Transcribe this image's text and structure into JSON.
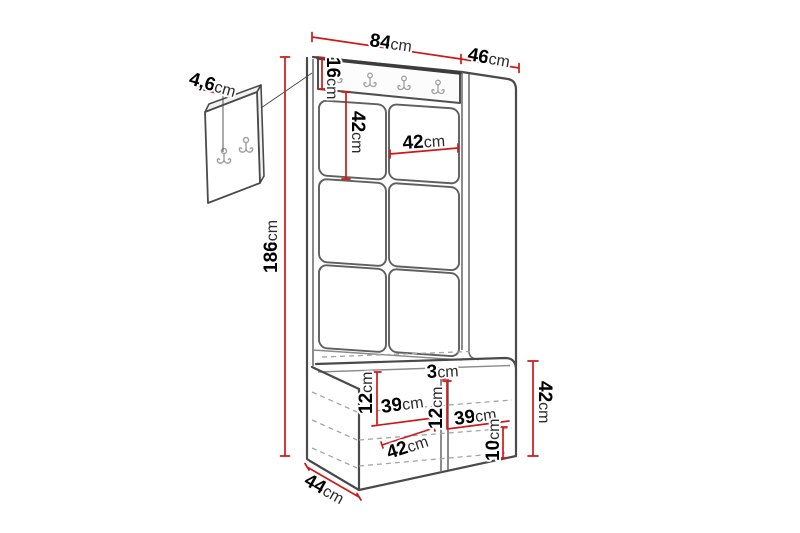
{
  "unit": "cm",
  "diagram": {
    "type": "furniture dimension diagram",
    "dimensions": {
      "wall_panel_thickness": {
        "value": "4,6"
      },
      "total_width": {
        "value": "84"
      },
      "total_depth": {
        "value": "46"
      },
      "hook_rail_height": {
        "value": "16"
      },
      "panel_tile_height": {
        "value": "42"
      },
      "panel_tile_width": {
        "value": "42"
      },
      "total_height": {
        "value": "186"
      },
      "left_compartment_height": {
        "value": "12"
      },
      "left_compartment_width": {
        "value": "39"
      },
      "center_divider_width": {
        "value": "3"
      },
      "right_compartment_height": {
        "value": "12"
      },
      "right_compartment_width": {
        "value": "39"
      },
      "bench_inner_depth": {
        "value": "42"
      },
      "bottom_panel_height": {
        "value": "10"
      },
      "bench_height": {
        "value": "42"
      },
      "bench_depth": {
        "value": "44"
      }
    },
    "colors": {
      "dimension_line": "#cc1a1a",
      "outline": "#4a4a4a",
      "hook": "#a0a0a0",
      "hidden_edge": "#a5a5a5"
    },
    "icons": {
      "coat_hook": "double-prong coat hook"
    }
  }
}
